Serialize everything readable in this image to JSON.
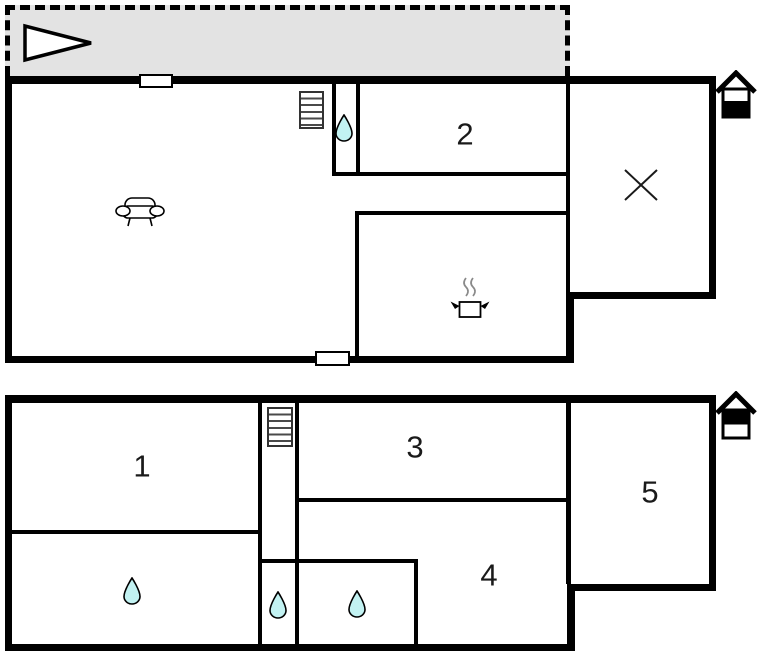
{
  "diagram": {
    "kind": "floor-plan",
    "floors": [
      {
        "id": "upper-plan",
        "rooms": [
          {
            "label": "2"
          }
        ],
        "features": [
          "terrace",
          "direction-arrow",
          "stairs",
          "water-drop",
          "sofa",
          "cooking-pot",
          "cross-mark",
          "house-level-indicator"
        ],
        "house_level_indicator": "bottom-half-filled"
      },
      {
        "id": "lower-plan",
        "rooms": [
          {
            "label": "1"
          },
          {
            "label": "3"
          },
          {
            "label": "4"
          },
          {
            "label": "5"
          }
        ],
        "features": [
          "stairs",
          "water-drop",
          "water-drop",
          "water-drop",
          "house-level-indicator"
        ],
        "house_level_indicator": "top-half-filled"
      }
    ]
  },
  "colors": {
    "wall": "#000000",
    "terrace_fill": "#e3e3e3",
    "water_drop": "#c2f2f2",
    "steam": "#8a8a8a",
    "background": "#ffffff"
  }
}
